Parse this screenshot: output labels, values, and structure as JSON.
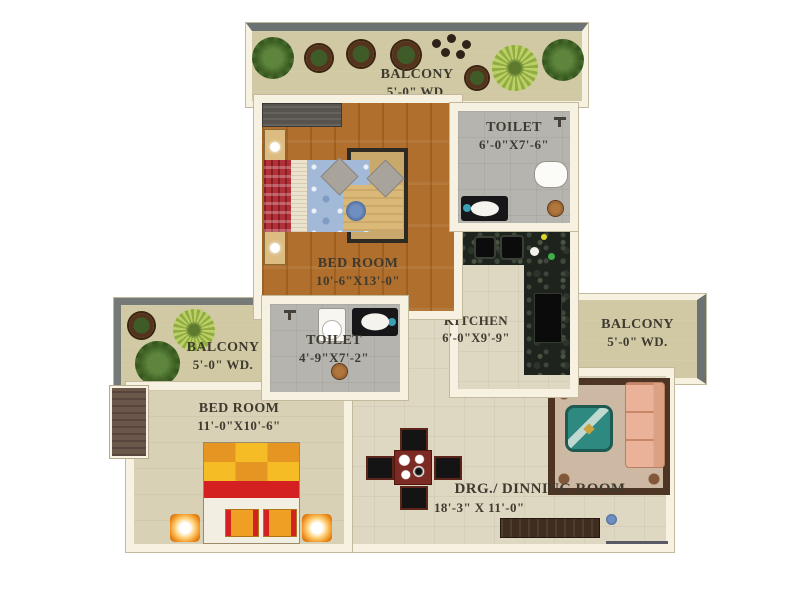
{
  "rooms": {
    "balcony_top": {
      "name": "BALCONY",
      "size": "5'-0\" WD."
    },
    "toilet_top": {
      "name": "TOILET",
      "size": "6'-0\"X7'-6\""
    },
    "bedroom_top": {
      "name": "BED ROOM",
      "size": "10'-6\"X13'-0\""
    },
    "kitchen": {
      "name": "KITCHEN",
      "size": "6'-0\"X9'-9\""
    },
    "balcony_right": {
      "name": "BALCONY",
      "size": "5'-0\" WD."
    },
    "balcony_left": {
      "name": "BALCONY",
      "size": "5'-0\" WD."
    },
    "toilet_mid": {
      "name": "TOILET",
      "size": "4'-9\"X7'-2\""
    },
    "bedroom_bottom": {
      "name": "BED ROOM",
      "size": "11'-0\"X10'-6\""
    },
    "dining": {
      "name": "DRG./ DINNING ROOM",
      "size": "18'-3\"  X 11'-0\""
    }
  },
  "palette": {
    "wall": "#f6f1e0",
    "wood_floor": "#b06f2d",
    "tile_floor": "#ded7c2",
    "balcony_floor": "#d0c9a4",
    "toilet_floor": "#b6b4af",
    "granite_counter": "#1e231d",
    "label_text": "#3e3a2f",
    "balcony_edge_gray": "#6c7173",
    "bed_checker_orange": "#e59522",
    "bed_checker_yellow": "#f5bc25",
    "bed_band_red": "#d42020",
    "sofa_salmon": "#e9b299",
    "table_teal": "#2e8a80",
    "dining_table_maroon": "#7c2b24"
  }
}
